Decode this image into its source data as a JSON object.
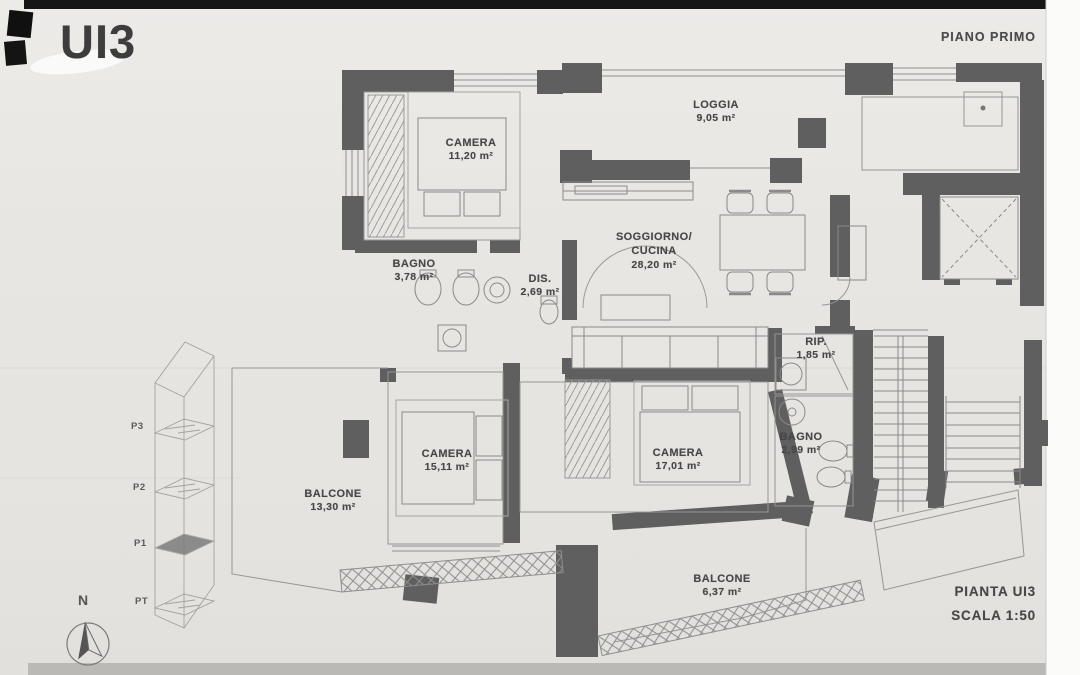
{
  "header": {
    "unit_label": "UI3",
    "floor_label": "PIANO PRIMO"
  },
  "footer": {
    "plan_label": "PIANTA UI3",
    "scale_label": "SCALA 1:50"
  },
  "compass": {
    "north_label": "N"
  },
  "key_plan": {
    "levels": [
      "P3",
      "P2",
      "P1",
      "PT"
    ],
    "highlighted_level": "P1"
  },
  "rooms": [
    {
      "id": "camera-1",
      "name": "CAMERA",
      "area": "11,20 m²"
    },
    {
      "id": "loggia",
      "name": "LOGGIA",
      "area": "9,05 m²"
    },
    {
      "id": "bagno-1",
      "name": "BAGNO",
      "area": "3,78 m²"
    },
    {
      "id": "disimpegno",
      "name": "DIS.",
      "area": "2,69 m²"
    },
    {
      "id": "soggiorno-cucina",
      "name": "SOGGIORNO/",
      "name2": "CUCINA",
      "area": "28,20 m²"
    },
    {
      "id": "ripostiglio",
      "name": "RIP.",
      "area": "1,85 m²"
    },
    {
      "id": "camera-2",
      "name": "CAMERA",
      "area": "15,11 m²"
    },
    {
      "id": "camera-3",
      "name": "CAMERA",
      "area": "17,01 m²"
    },
    {
      "id": "bagno-2",
      "name": "BAGNO",
      "area": "2,99 m²"
    },
    {
      "id": "balcone-1",
      "name": "BALCONE",
      "area": "13,30 m²"
    },
    {
      "id": "balcone-2",
      "name": "BALCONE",
      "area": "6,37 m²"
    }
  ],
  "colors": {
    "paper": "#e8e6e2",
    "wall": "#5f5f5f",
    "thin_line": "#8f8f8f",
    "text": "#474747"
  }
}
